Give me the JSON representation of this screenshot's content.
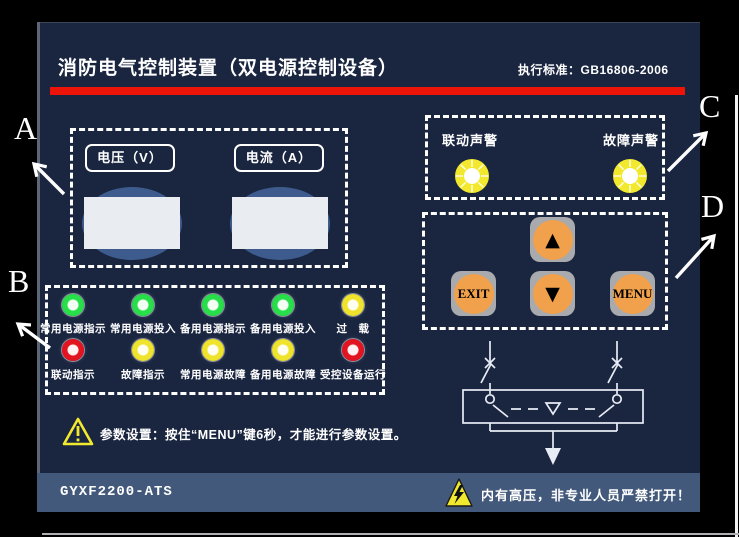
{
  "header": {
    "title": "消防电气控制装置（双电源控制设备）",
    "standard_label": "执行标准：GB16806-2006"
  },
  "annotations": {
    "a": "A",
    "b": "B",
    "c": "C",
    "d": "D"
  },
  "meters": {
    "voltage_label": "电压（V）",
    "current_label": "电流（A）"
  },
  "alarms": {
    "linkage_label": "联动声警",
    "fault_label": "故障声警"
  },
  "keypad": {
    "up": "▲",
    "down": "▼",
    "exit": "EXIT",
    "menu": "MENU"
  },
  "indicators": {
    "row1": [
      {
        "color": "green",
        "label": "常用电源指示"
      },
      {
        "color": "green",
        "label": "常用电源投入"
      },
      {
        "color": "green",
        "label": "备用电源指示"
      },
      {
        "color": "green",
        "label": "备用电源投入"
      },
      {
        "color": "yellow",
        "label": "过　载"
      }
    ],
    "row2": [
      {
        "color": "red",
        "label": "联动指示"
      },
      {
        "color": "yellow",
        "label": "故障指示"
      },
      {
        "color": "yellow",
        "label": "常用电源故障"
      },
      {
        "color": "yellow",
        "label": "备用电源故障"
      },
      {
        "color": "red",
        "label": "受控设备运行"
      }
    ]
  },
  "notes": {
    "param": "参数设置：按住“MENU”键6秒，才能进行参数设置。"
  },
  "footer": {
    "model": "GYXF2200-ATS",
    "high_voltage_warning": "内有高压，非专业人员严禁打开！"
  },
  "colors": {
    "panel": "#1a2540",
    "footer_bar": "#42597b",
    "accent_red": "#ec1309",
    "led_green": "#27df49",
    "led_yellow": "#efe32b",
    "led_red": "#e11420",
    "button_orange": "#f1a14c",
    "button_gray": "#a8aaad",
    "buzzer_yellow": "#f2e92f",
    "display_blue": "#3d5b8c"
  }
}
